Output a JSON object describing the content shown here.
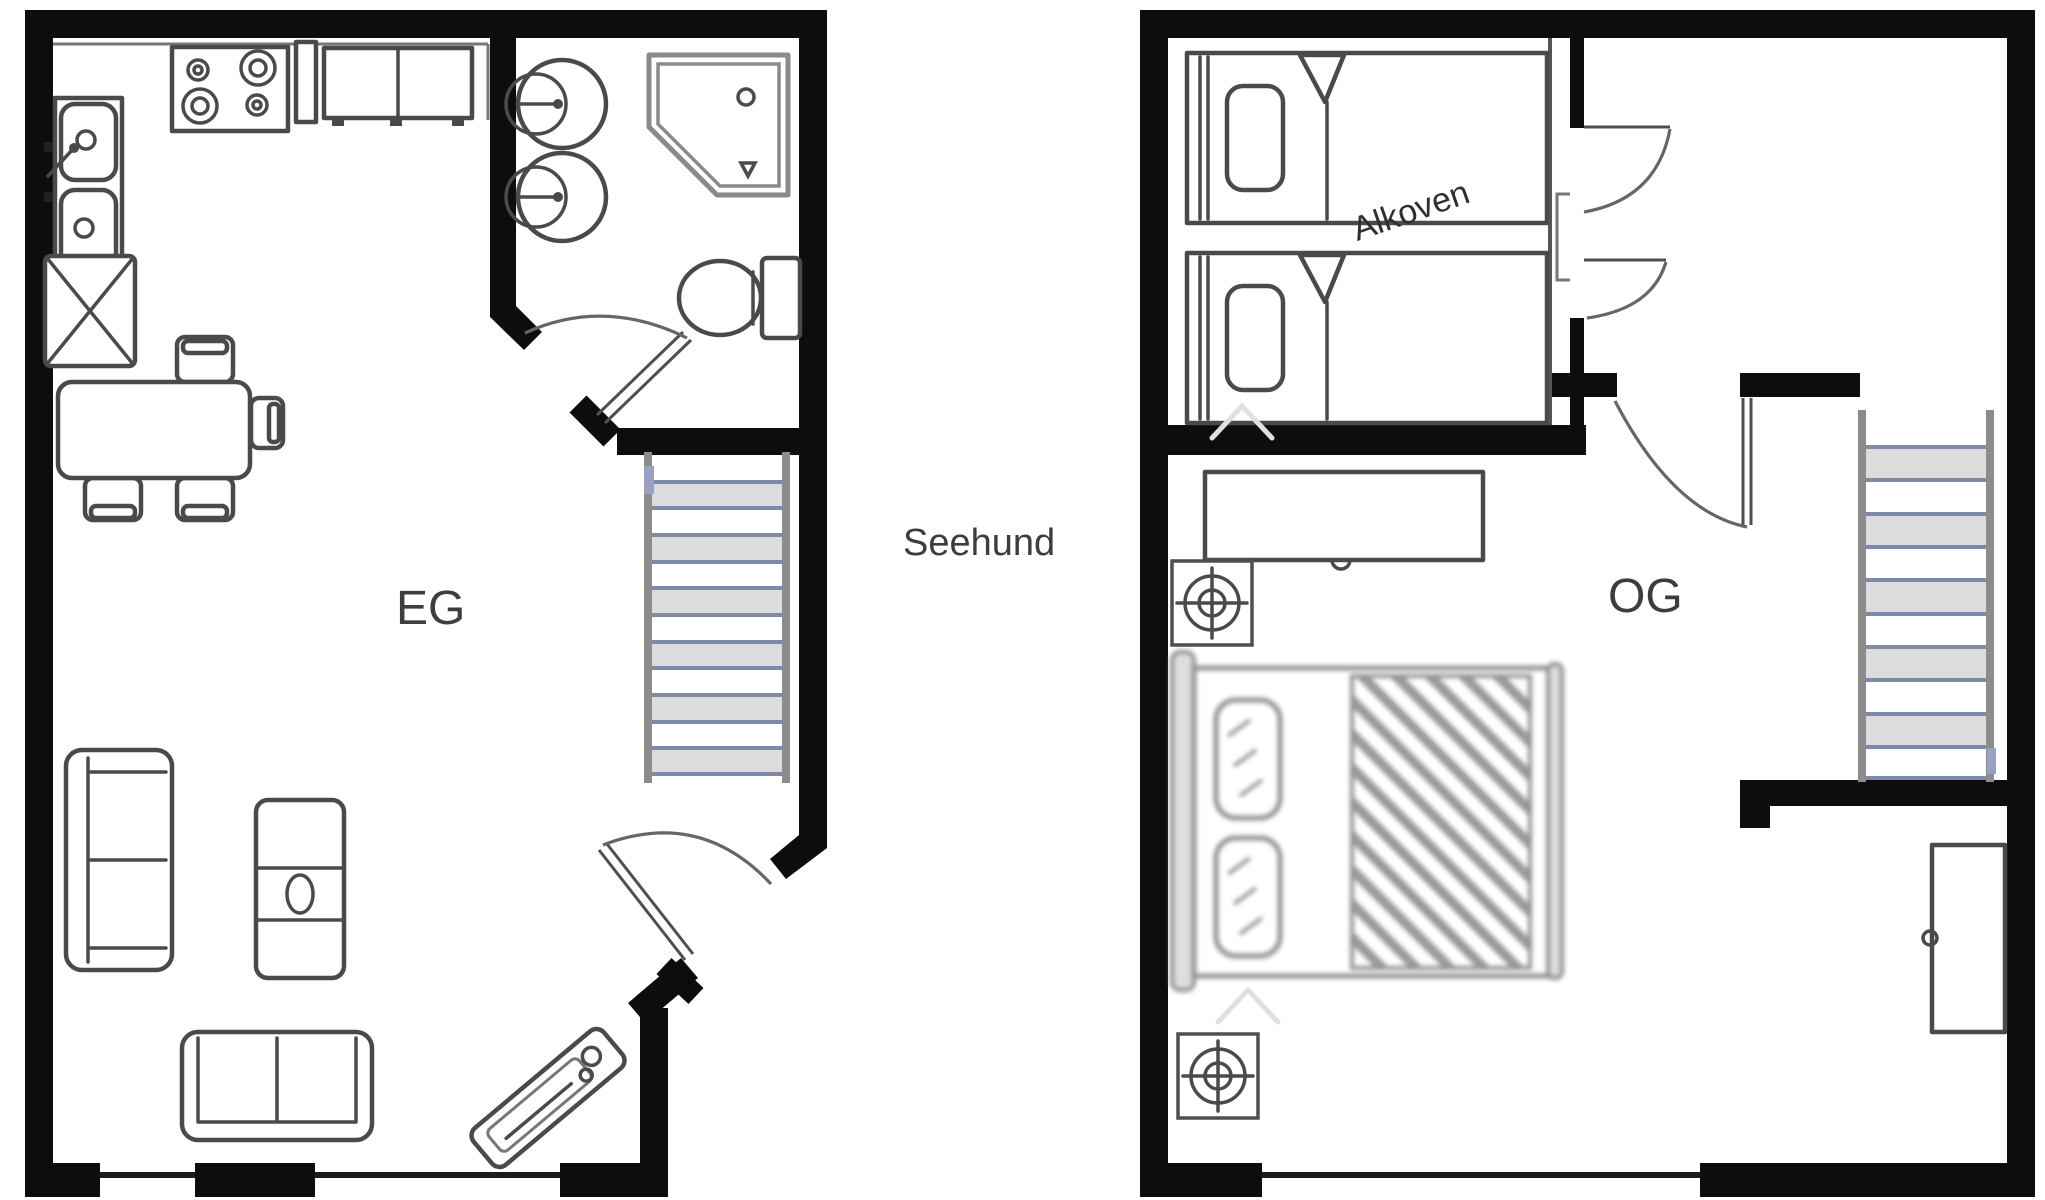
{
  "title": "Seehund",
  "plans": {
    "eg": {
      "label": "EG",
      "furniture": [
        "double-sink",
        "stove",
        "kitchen-cabinet-narrow",
        "kitchen-cabinet-double",
        "tall-cabinet-x",
        "dining-table",
        "dining-chairs",
        "washbasin-1",
        "washbasin-2",
        "corner-shower",
        "toilet",
        "staircase",
        "two-seat-sofa",
        "armchair",
        "loveseat-sofa",
        "entry-bench"
      ],
      "doors": [
        "bathroom-door",
        "entrance-door"
      ]
    },
    "og": {
      "label": "OG",
      "alcove_label": "Alkoven",
      "furniture": [
        "single-bed-1",
        "single-bed-2",
        "sideboard",
        "ceiling-light-symbol-1",
        "ceiling-light-symbol-2",
        "double-bed",
        "staircase",
        "wardrobe"
      ],
      "doors": [
        "alcove-door-upper",
        "alcove-door-lower",
        "room-door"
      ]
    }
  },
  "colors": {
    "wall": "#0d0d0d",
    "furniture_line": "#4a4a4a",
    "soft_line": "#8a8a8a",
    "stair_rail": "#8c8c8c",
    "stair_step_line": "#7e89a8",
    "stair_step_fill": "#dcdcdc",
    "accent_mark_blue": "#98a0c6",
    "label_text": "#3d3d3d"
  }
}
